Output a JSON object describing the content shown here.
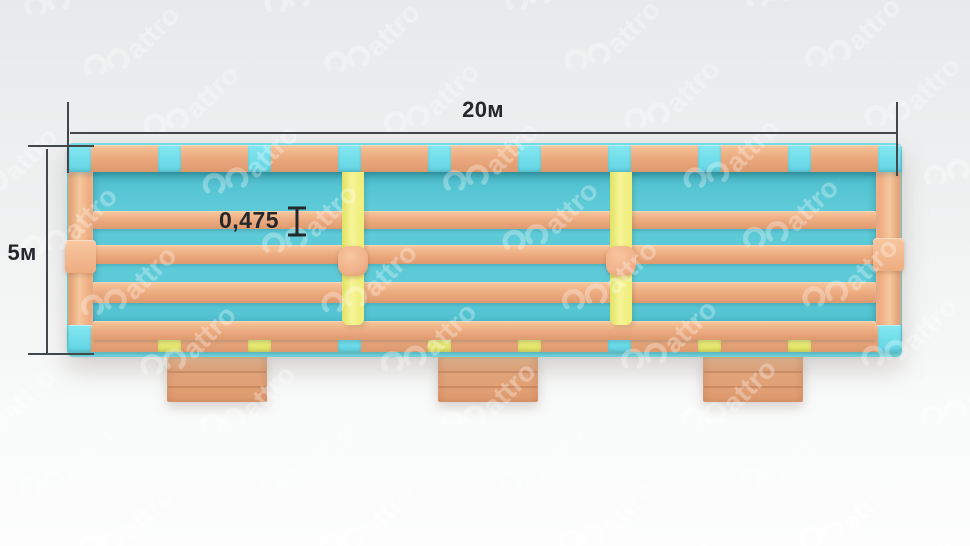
{
  "annotations": {
    "width": "20м",
    "height": "5м",
    "beam": "0,475"
  },
  "watermark": {
    "text": "attro"
  },
  "palette": {
    "bg_top": "#e7eaeb",
    "bg_mid": "#f0f2f2",
    "bg_bottom": "#fafbfb",
    "line": "#41474a",
    "ink": "#24282b",
    "peach_light": "#f6c79d",
    "peach": "#eeac81",
    "peach_dark": "#dd9a6e",
    "cyan_floor": "#5dcad7",
    "cyan_floor_dark": "#4fc0cf",
    "cyan_square_light": "#84e8f2",
    "cyan_square": "#63d4e3",
    "rim": "#79dbe3",
    "yellow_light": "#f7f498",
    "yellow": "#f0ee7d",
    "yellow_dark": "#e0e263",
    "ball_light": "#f8c7a0",
    "ball": "#f0b189"
  },
  "structure": {
    "top_squares": [
      "cyan",
      "cyan",
      "cyan",
      "cyan",
      "cyan",
      "cyan",
      "cyan",
      "cyan",
      "cyan",
      "cyan"
    ],
    "bottom_squares": [
      "cyan",
      "yellow",
      "yellow",
      "cyan",
      "yellow",
      "yellow",
      "cyan",
      "yellow",
      "yellow",
      "cyan"
    ],
    "stripe_count": 4,
    "divider_count": 2,
    "ball_count": 2,
    "step_count": 3
  }
}
